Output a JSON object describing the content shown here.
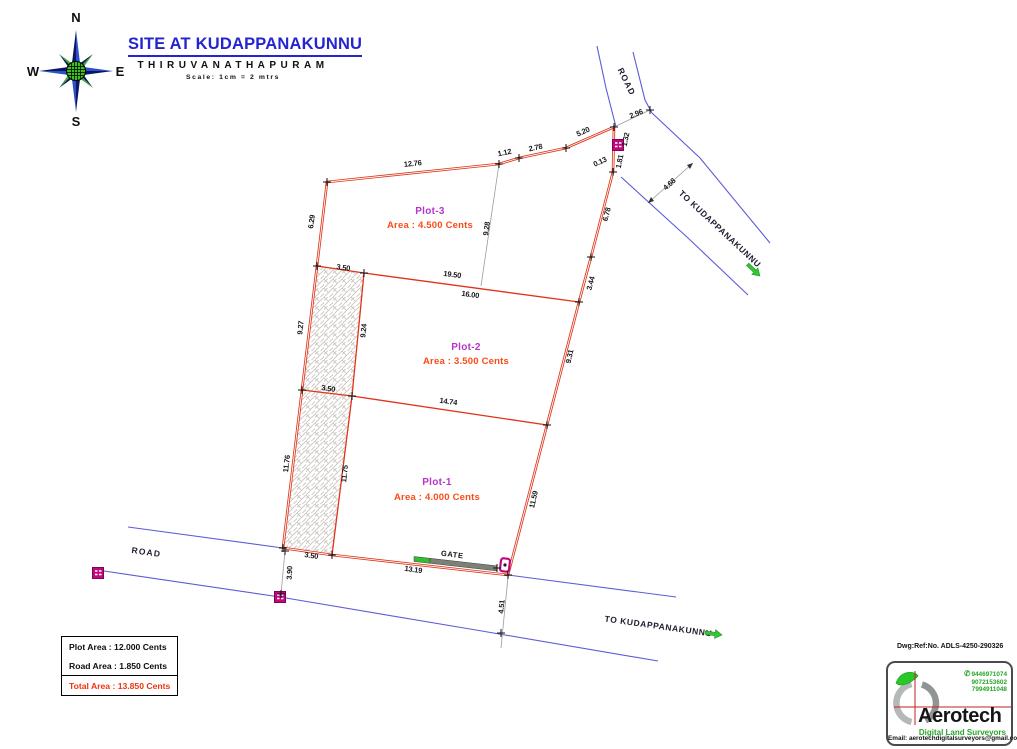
{
  "title": {
    "site": "SITE AT KUDAPPANAKUNNU",
    "city": "THIRUVANATHAPURAM",
    "scale": "Scale: 1cm = 2 mtrs"
  },
  "compass": {
    "n": "N",
    "e": "E",
    "s": "S",
    "w": "W"
  },
  "drawing": {
    "plots": [
      {
        "name": "Plot-1",
        "area": "Area : 4.000 Cents"
      },
      {
        "name": "Plot-2",
        "area": "Area : 3.500 Cents"
      },
      {
        "name": "Plot-3",
        "area": "Area : 4.500 Cents"
      }
    ],
    "gate_label": "GATE",
    "road_label_bottom": "ROAD",
    "road_label_top": "ROAD",
    "to_kudappanakunnu_top": "TO KUDAPPANAKUNNU",
    "to_kudappanakunnu_bottom": "TO KUDAPPANAKUNNU",
    "dims": {
      "d12_76": "12.76",
      "d1_12": "1.12",
      "d2_78": "2.78",
      "d5_20": "5.20",
      "d2_96": "2.96",
      "d1_32": "1.32",
      "d1_81": "1.81",
      "d0_13": "0.13",
      "d4_68": "4.68",
      "d6_78": "6.78",
      "d3_44": "3.44",
      "d9_31": "9.31",
      "d11_59": "11.59",
      "d4_51": "4.51",
      "d6_29": "6.29",
      "d9_27": "9.27",
      "d11_76": "11.76",
      "d9_24": "9.24",
      "d11_75": "11.75",
      "d9_28": "9.28",
      "d3_50_top": "3.50",
      "d19_50": "19.50",
      "d16_00": "16.00",
      "d3_50_mid": "3.50",
      "d14_74": "14.74",
      "d3_50_bot": "3.50",
      "d13_19": "13.19",
      "d3_90": "3.90"
    }
  },
  "area_table": {
    "plot_area": "Plot Area : 12.000 Cents",
    "road_area": "Road Area :  1.850 Cents",
    "total_area": "Total Area : 13.850 Cents"
  },
  "footer": {
    "dwg_ref": "Dwg:Ref:No. ADLS-4250-290326",
    "logo": {
      "brand": "Aerotech",
      "tagline": "Digital Land Surveyors",
      "phone_icon": "✆",
      "phones": [
        "9446971074",
        "9072153602",
        "7994911048"
      ],
      "email": "Email: aerotechdigitalsurveyors@gmail.com"
    }
  },
  "colors": {
    "boundary_red": "#e03318",
    "road_blue": "#5c5cd6",
    "plot_name_magenta": "#b535c8",
    "area_orange_red": "#fd4a17",
    "post_magenta": "#c0087e",
    "arrow_green": "#35c435",
    "title_blue": "#2424d0",
    "logo_green": "#28a428"
  }
}
